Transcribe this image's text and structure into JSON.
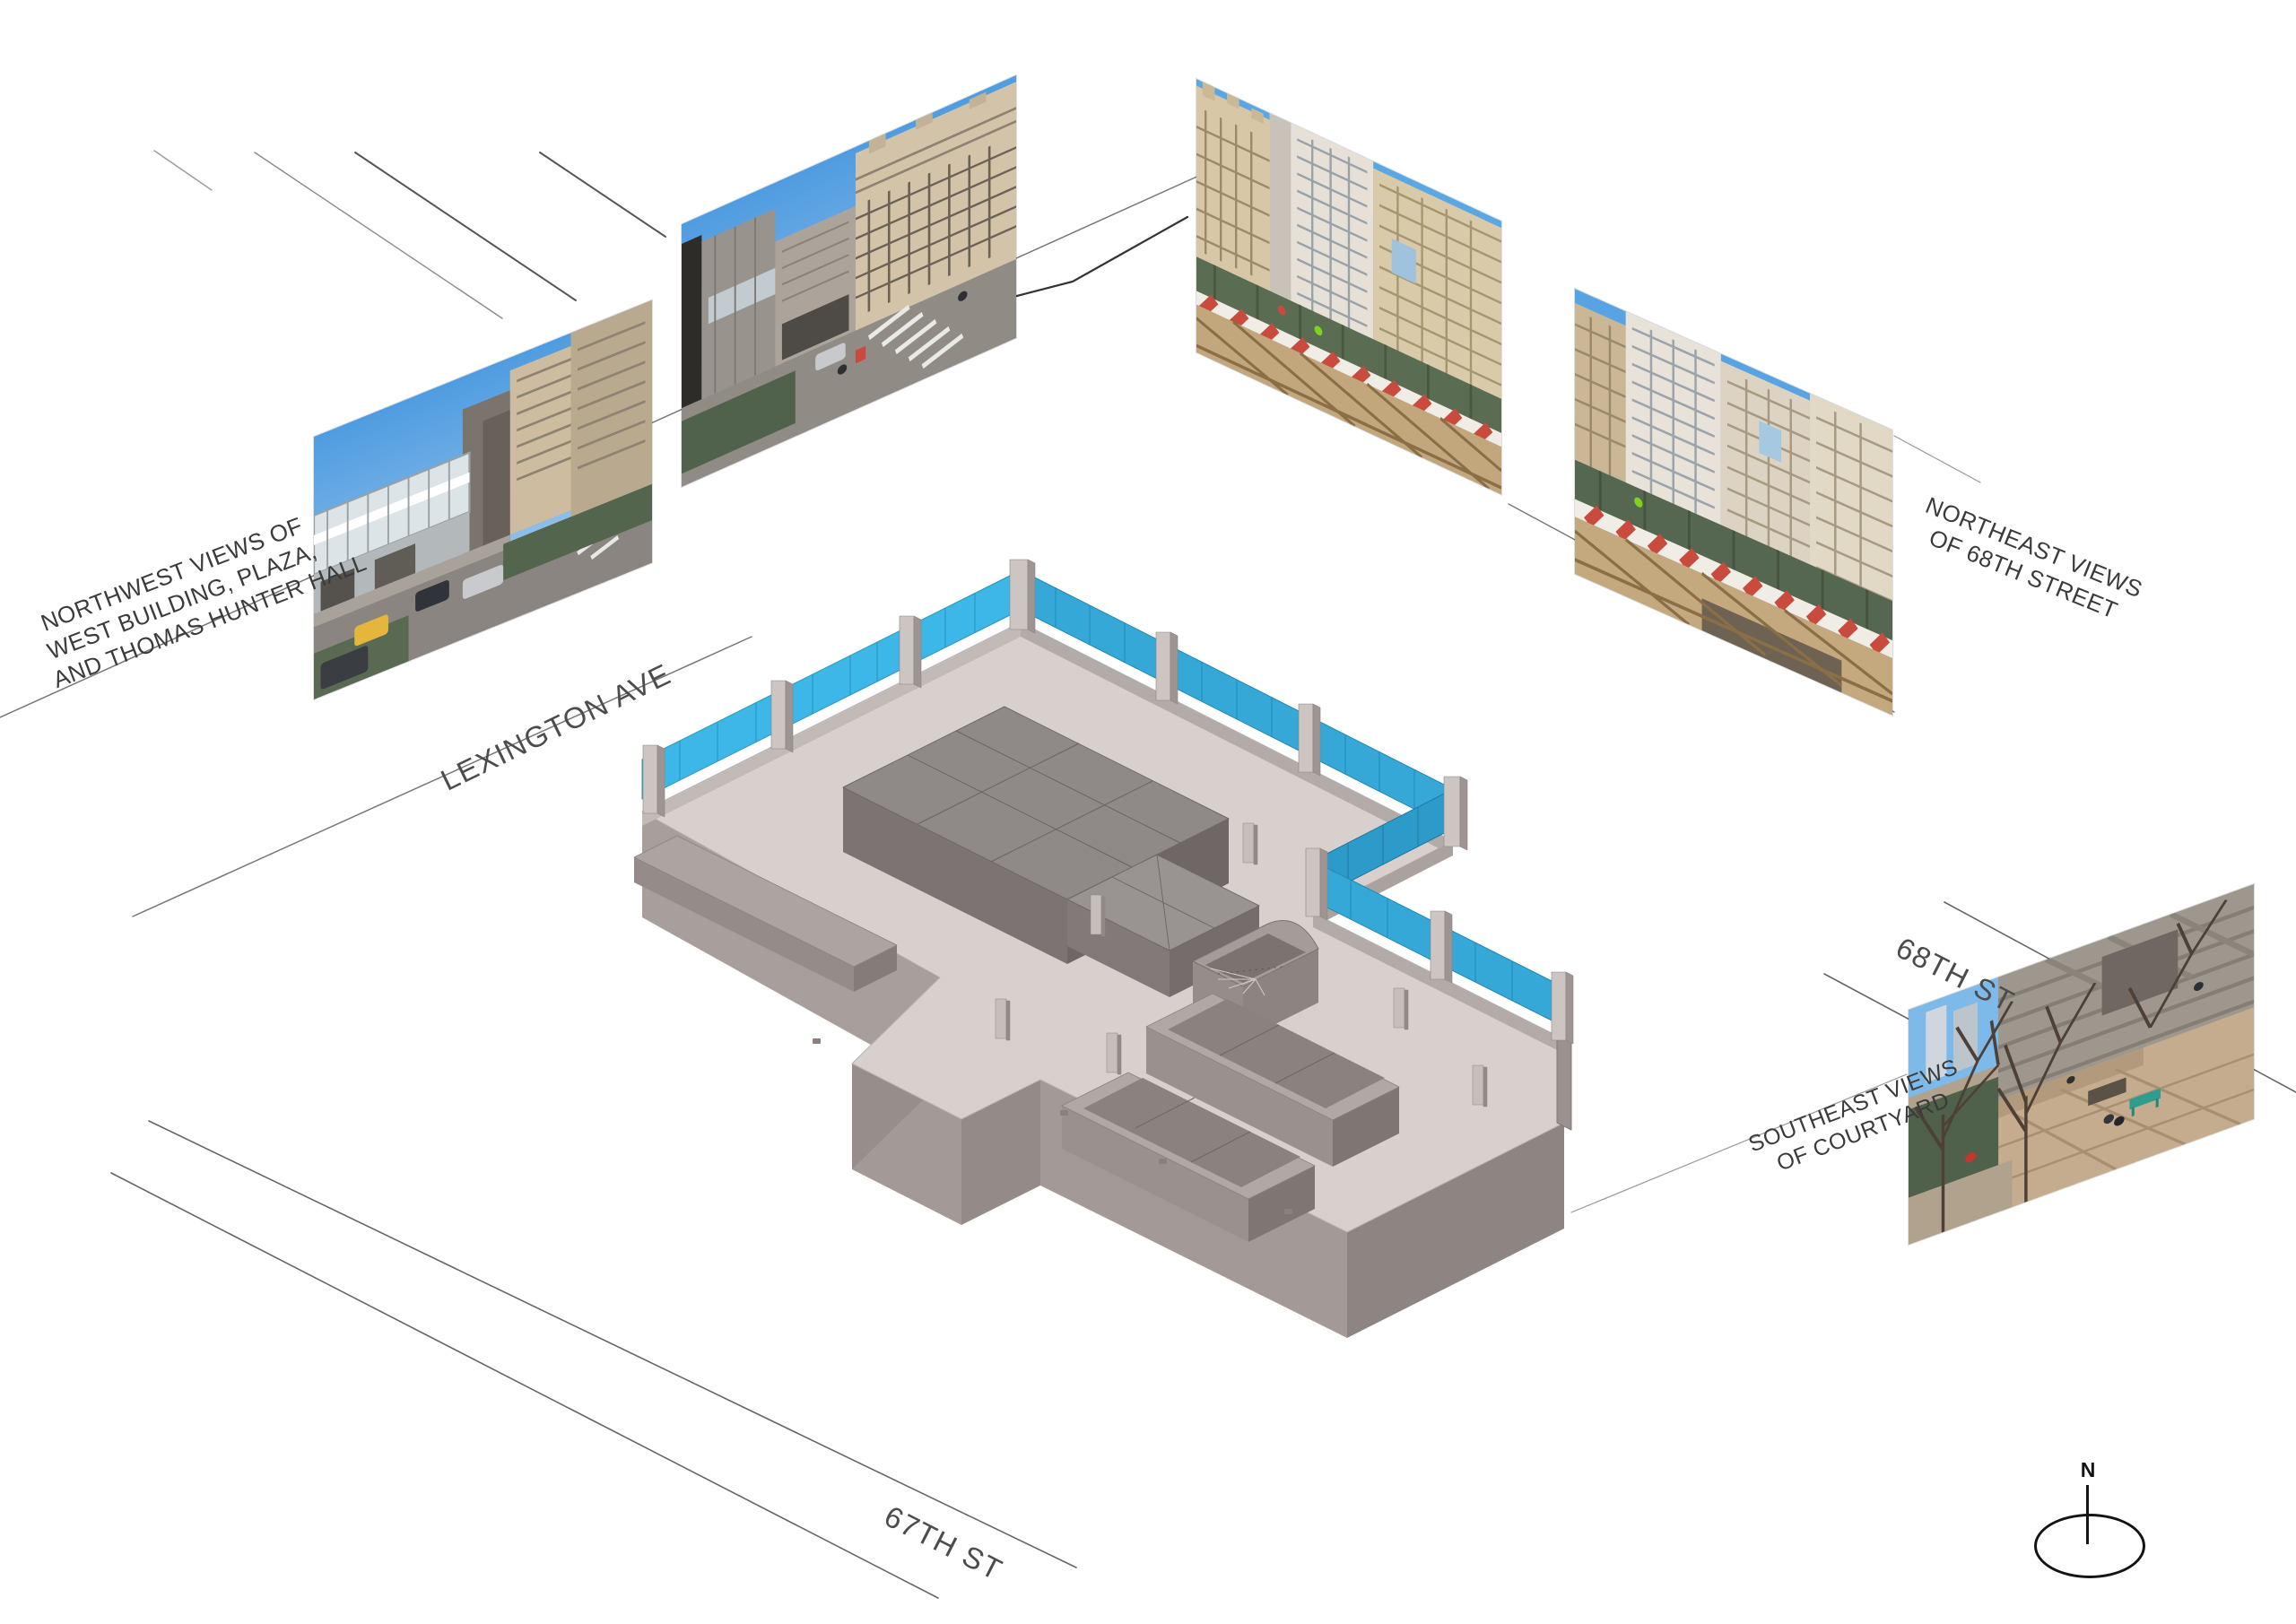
{
  "document": {
    "kind": "architectural axonometric site diagram",
    "background": "#ffffff"
  },
  "annotations": {
    "northwest": {
      "lines": [
        "NORTHWEST VIEWS OF",
        "WEST BUILDING, PLAZA,",
        "AND THOMAS HUNTER HALL"
      ]
    },
    "northeast": {
      "lines": [
        "NORTHEAST VIEWS",
        "OF 68TH STREET"
      ]
    },
    "southeast": {
      "lines": [
        "SOUTHEAST VIEWS",
        "OF COURTYARD"
      ]
    }
  },
  "streets": {
    "lexington": "LEXINGTON AVE",
    "sixty_eighth": "68TH ST",
    "sixty_seventh": "67TH ST"
  },
  "compass": {
    "label": "N"
  },
  "photos": [
    {
      "id": "northwest-view-1",
      "group": "northwest"
    },
    {
      "id": "northwest-view-2",
      "group": "northwest"
    },
    {
      "id": "northeast-view-1",
      "group": "northeast"
    },
    {
      "id": "northeast-view-2",
      "group": "northeast"
    },
    {
      "id": "southeast-courtyard-view",
      "group": "southeast"
    }
  ],
  "colors": {
    "glass_fence": "#3db7e7",
    "glass_fence_shaded": "#2f9fd0",
    "floor": "#d7d0cd",
    "wall_light": "#cdc5c2",
    "wall_medium": "#a39a97",
    "wall_dark": "#8e8481",
    "core_roof": "#8f8987",
    "core_side": "#6f6765",
    "street_line": "#666666",
    "construction_fence_green": "#53654d",
    "sky_blue": "#5aa7e4",
    "taxi_yellow": "#e6b63c",
    "barrier_red": "#c94b3e",
    "bench_teal": "#2e9d8e"
  }
}
